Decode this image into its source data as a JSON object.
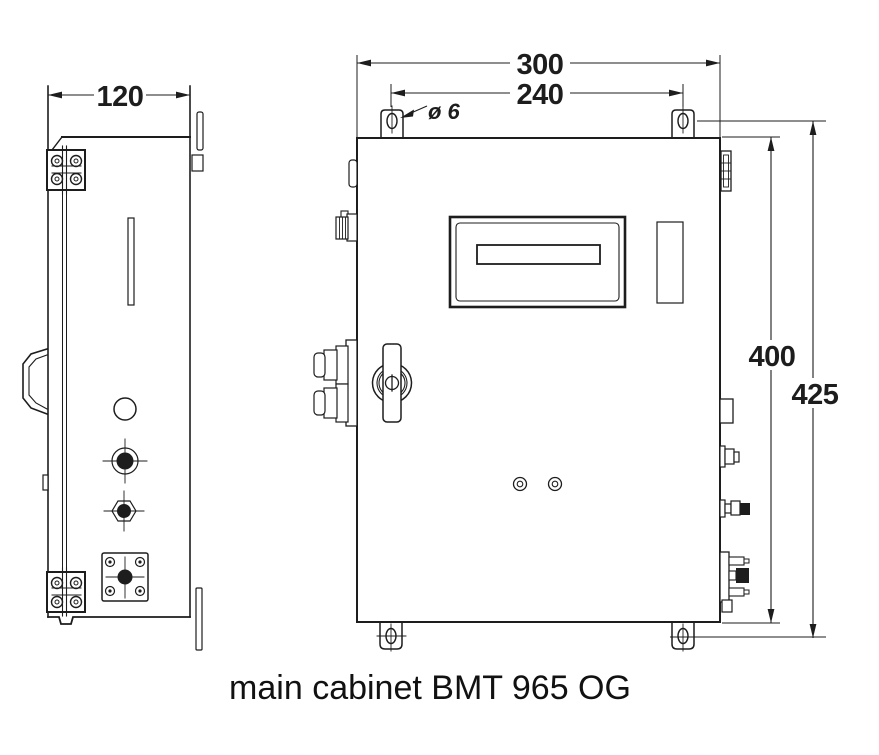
{
  "drawing": {
    "caption": "main cabinet BMT 965 OG",
    "dimensions": {
      "side_width": "120",
      "front_width": "300",
      "hole_spacing": "240",
      "hole_diameter": "ø 6",
      "body_height": "400",
      "overall_height": "425"
    },
    "colors": {
      "line": "#1d1d1d",
      "background": "#ffffff"
    }
  }
}
